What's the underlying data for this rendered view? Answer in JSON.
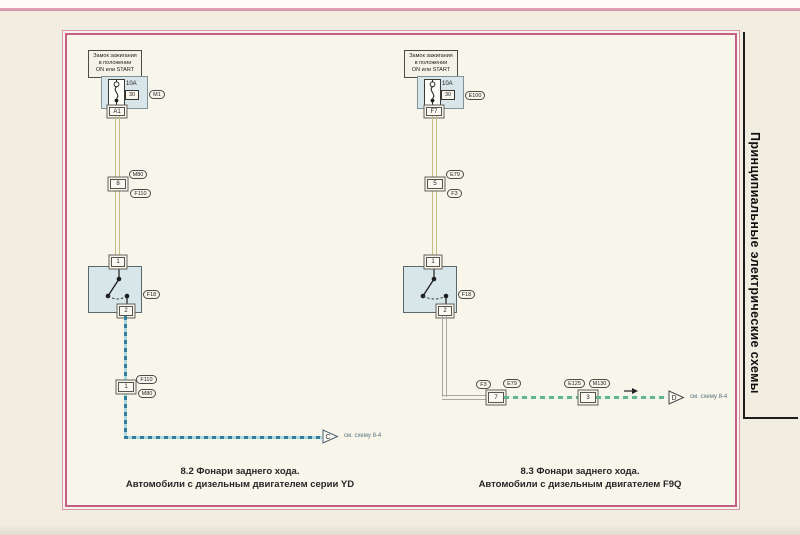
{
  "colors": {
    "frame_pink": "#c55f87",
    "power_wire": "#c4bc83",
    "reverse_wire_left": "#2f7f9d",
    "reverse_wire_right": "#63b68c",
    "component_fill": "#d8e5e9"
  },
  "sidebar": {
    "title": "Принципиальные электрические схемы"
  },
  "left": {
    "ignition": [
      "Замок зажигания",
      "в положении",
      "ON или START"
    ],
    "fuse_amps": "10A",
    "fuse_slot": "30",
    "unit": "M1",
    "fuse_out_pin": "A1",
    "mid_pin": "8",
    "mid_top": "M80",
    "mid_bottom": "F110",
    "sw_pin_top": "1",
    "sw_pin_bottom": "2",
    "sw_label": "F18",
    "low_pin": "1",
    "low_top": "F110",
    "low_bottom": "M80",
    "arrow_letter": "C",
    "arrow_note": "см. схему 8-4",
    "caption1": "8.2 Фонари заднего хода.",
    "caption2": "Автомобили с дизельным двигателем серии YD"
  },
  "right": {
    "ignition": [
      "Замок зажигания",
      "в положении",
      "ON или START"
    ],
    "fuse_amps": "10A",
    "fuse_slot": "30",
    "unit": "E100",
    "fuse_out_pin": "F7",
    "mid_pin": "5",
    "mid_top": "E79",
    "mid_bottom": "F3",
    "sw_pin_top": "1",
    "sw_pin_bottom": "2",
    "sw_label": "F18",
    "conn7_pin": "7",
    "conn7_left": "F3",
    "conn7_right": "E79",
    "conn3_pin": "3",
    "conn3_left": "E125",
    "conn3_right": "M130",
    "arrow_letter": "D",
    "arrow_note": "см. схему 8-4",
    "caption1": "8.3 Фонари заднего хода.",
    "caption2": "Автомобили с дизельным двигателем F9Q"
  }
}
